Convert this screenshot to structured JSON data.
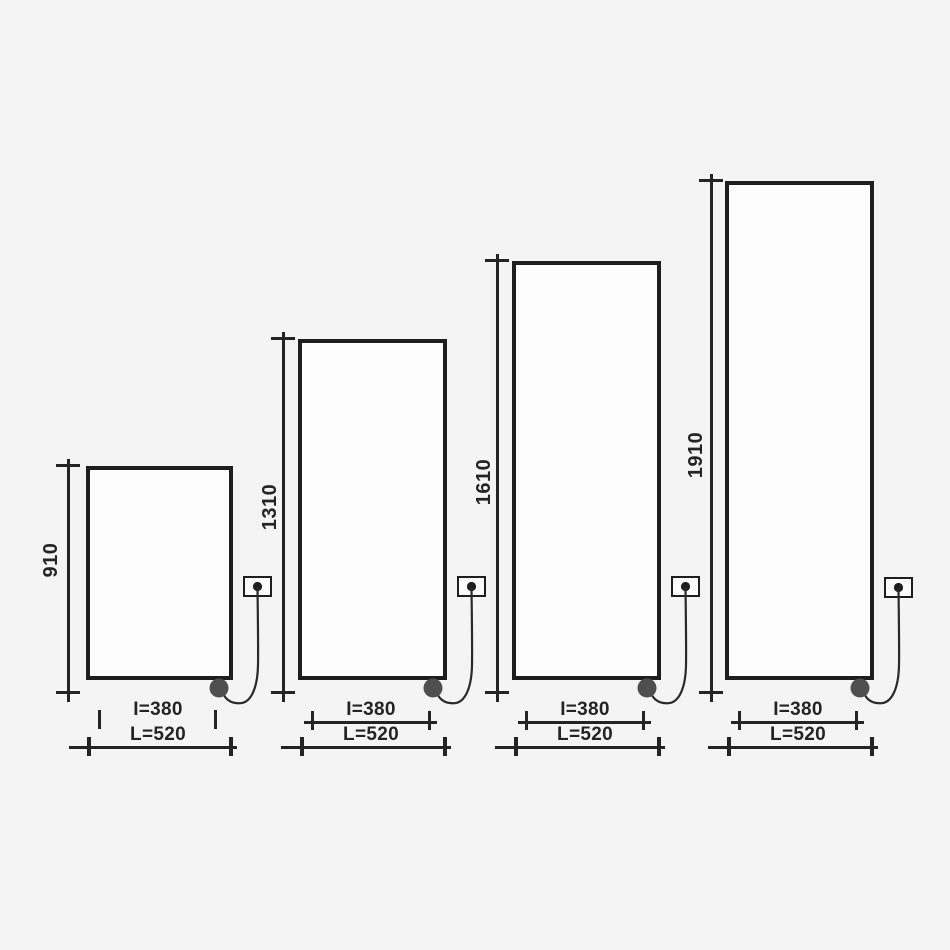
{
  "diagram": {
    "panels": [
      {
        "height": "910",
        "inner_width": "I=380",
        "outer_width": "L=520"
      },
      {
        "height": "1310",
        "inner_width": "I=380",
        "outer_width": "L=520"
      },
      {
        "height": "1610",
        "inner_width": "I=380",
        "outer_width": "L=520"
      },
      {
        "height": "1910",
        "inner_width": "I=380",
        "outer_width": "L=520"
      }
    ],
    "colors": {
      "line": "#242424",
      "plug": "#4f4f4f",
      "background": "#f4f4f4",
      "panel_fill": "#fdfdfd"
    }
  }
}
